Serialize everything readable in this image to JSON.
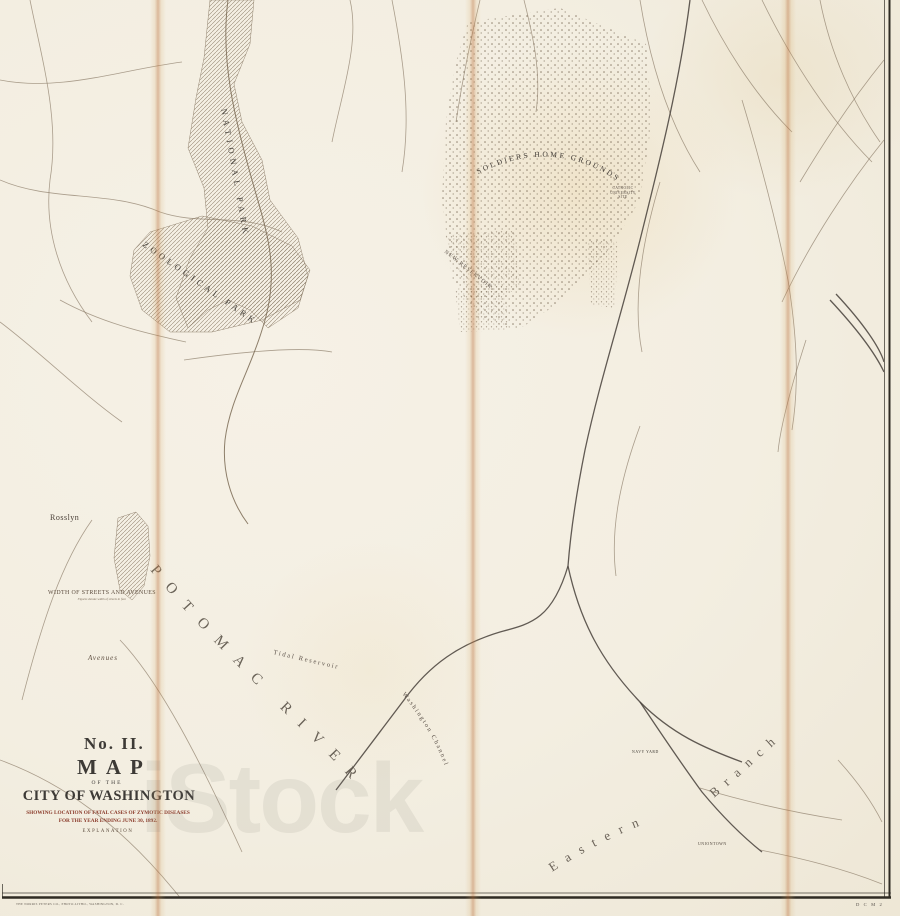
{
  "map": {
    "title_block": {
      "number": "No. II.",
      "map_word": "MAP",
      "of_the": "OF THE",
      "city": "CITY OF WASHINGTON",
      "subtitle1": "SHOWING LOCATION OF FATAL CASES OF ZYMOTIC DISEASES",
      "subtitle2": "FOR THE YEAR ENDING JUNE 30, 1892.",
      "explanation": "EXPLANATION",
      "legend": [
        {
          "label": "TYPHOID FEVER",
          "color": "#1f1f1f"
        },
        {
          "label": "MALARIAL FEVER",
          "color": "#24406e"
        },
        {
          "label": "SCARLET FEVER",
          "color": "#c8352b"
        },
        {
          "label": "DIPHTHERIA",
          "color": "#8d2d22"
        },
        {
          "label": "DIARRHŒAL DISEASES",
          "color": "#d1574a"
        }
      ]
    },
    "labels": {
      "rosslyn": "Rosslyn",
      "national_park": "NATIONAL PARK",
      "zoological_park": "ZOOLOGICAL PARK",
      "soldiers_home": "SOLDIERS HOME GROUNDS",
      "catholic_univ": "CATHOLIC UNIVERSITY SITE",
      "new_reservoir": "NEW RESERVOIR",
      "tidal_reservoir": "Tidal Reservoir",
      "washington_channel": "Washington Channel",
      "potomac_river": "POTOMAC RIVER",
      "eastern": "Eastern",
      "branch": "Branch",
      "navy_yard": "NAVY YARD",
      "uniontown": "UNIONTOWN"
    },
    "streets_block": {
      "heading": "WIDTH OF STREETS AND AVENUES",
      "sections": [
        {
          "name": "North",
          "rows": [
            "B.82 C.80 D.85 E.90 F.95 G.90 H.90 I.80 K.95 L.90 M.90",
            "N.90 O.90 P.98 Q.84 R.90 S.90 T.85 U.90 V.80 W.90"
          ]
        },
        {
          "name": "South",
          "rows": [
            "B.82 C.80 D.85 E.84 F.90 G.96 H.80 I.84 K.90 L.84 M.90",
            "N.85 O.90 P.84 Q.90 R.80 S.84 T.90 U.84 V.80"
          ]
        },
        {
          "name": "East",
          "rows": [
            "1.80 2.85 3.90 4.85 5.80 6.90 7.95 8.85 9.90 10.80 11.85",
            "12.90 13.80 14.95 15.88 16.80 17.84 18.80 19.84 20.80"
          ]
        },
        {
          "name": "West",
          "rows": [
            "1.84 2.80 3.90 4.85 5.80 6.90 7.95 8.85 9.90 10.80 11.85 12.90",
            "13.80 14.95 15.88 16.80 17.84 18.80 19.84 20.80 21.84 22.80 23.80 24.85",
            "25.80 26.84 27.80 28.85 29.80 30.84 31.80 32.85 33.80 34.84 35.80 36.84"
          ]
        }
      ],
      "caption": "Figures denote width of streets in feet."
    },
    "avenues_table": {
      "heading": "Avenues",
      "left": [
        {
          "name": "Connecticut",
          "val": "130"
        },
        {
          "name": "Delaware",
          "val": "160"
        },
        {
          "name": "Florida",
          "val": "120"
        },
        {
          "name": "Georgia",
          "val": "120"
        },
        {
          "name": "Indiana",
          "val": "120"
        },
        {
          "name": "Kentucky",
          "val": "90"
        },
        {
          "name": "Louisiana",
          "val": "129"
        },
        {
          "name": "Maryland",
          "val": "160"
        },
        {
          "name": "Massachusetts",
          "val": "160"
        },
        {
          "name": "Missouri",
          "val": "100"
        },
        {
          "name": "New York East of 6th St.",
          "val": "160"
        },
        {
          "name": "New York West of 6th St.",
          "val": "130"
        }
      ],
      "right": [
        {
          "name": "New Jersey",
          "val": "160"
        },
        {
          "name": "North Carolina",
          "val": "160"
        },
        {
          "name": "New Hampshire",
          "val": "130"
        },
        {
          "name": "Ohio",
          "val": "102"
        },
        {
          "name": "Pennsylvania East of 6th St.",
          "val": "160"
        },
        {
          "name": "Pennsylvania West of 6th St.",
          "val": "130"
        },
        {
          "name": "Rhode Island",
          "val": "130"
        },
        {
          "name": "South Carolina",
          "val": "160"
        },
        {
          "name": "Tennessee",
          "val": "160"
        },
        {
          "name": "Vermont",
          "val": "130"
        },
        {
          "name": "Virginia East of Canal",
          "val": "160"
        },
        {
          "name": "Virginia West of Canal",
          "val": "85"
        }
      ]
    },
    "case_markers": {
      "palette": {
        "typhoid": "#1f1f1f",
        "malarial": "#24406e",
        "scarlet": "#c8352b",
        "diphtheria": "#8d2d22",
        "diarrhoeal": "#d1574a"
      },
      "regions": [
        {
          "seed": 11,
          "x": 196,
          "y": 430,
          "w": 350,
          "h": 150,
          "counts": {
            "diarrhoeal": 30,
            "scarlet": 16,
            "diphtheria": 12,
            "malarial": 26,
            "typhoid": 11
          }
        },
        {
          "seed": 22,
          "x": 300,
          "y": 300,
          "w": 320,
          "h": 100,
          "counts": {
            "diarrhoeal": 14,
            "scarlet": 8,
            "diphtheria": 6,
            "malarial": 10,
            "typhoid": 5
          }
        },
        {
          "seed": 33,
          "x": 566,
          "y": 400,
          "w": 190,
          "h": 180,
          "counts": {
            "diarrhoeal": 18,
            "scarlet": 9,
            "diphtheria": 7,
            "malarial": 16,
            "typhoid": 7
          }
        },
        {
          "seed": 44,
          "x": 762,
          "y": 440,
          "w": 100,
          "h": 140,
          "counts": {
            "diarrhoeal": 6,
            "scarlet": 3,
            "diphtheria": 2,
            "malarial": 6,
            "typhoid": 2
          }
        },
        {
          "seed": 55,
          "x": 470,
          "y": 600,
          "w": 280,
          "h": 180,
          "counts": {
            "diarrhoeal": 24,
            "scarlet": 11,
            "diphtheria": 9,
            "malarial": 17,
            "typhoid": 9
          }
        },
        {
          "seed": 66,
          "x": 376,
          "y": 610,
          "w": 85,
          "h": 160,
          "counts": {
            "diarrhoeal": 9,
            "scarlet": 5,
            "diphtheria": 3,
            "malarial": 6,
            "typhoid": 3
          }
        },
        {
          "seed": 77,
          "x": 146,
          "y": 400,
          "w": 84,
          "h": 80,
          "counts": {
            "diarrhoeal": 6,
            "scarlet": 4,
            "diphtheria": 2,
            "malarial": 4,
            "typhoid": 2
          }
        },
        {
          "seed": 88,
          "x": 310,
          "y": 195,
          "w": 110,
          "h": 95,
          "counts": {
            "diarrhoeal": 3,
            "scarlet": 2,
            "diphtheria": 1,
            "malarial": 2,
            "typhoid": 1
          }
        },
        {
          "seed": 99,
          "x": 620,
          "y": 235,
          "w": 80,
          "h": 68,
          "counts": {
            "diarrhoeal": 3,
            "scarlet": 2,
            "diphtheria": 1,
            "malarial": 3,
            "typhoid": 1
          }
        },
        {
          "seed": 110,
          "x": 700,
          "y": 833,
          "w": 115,
          "h": 52,
          "counts": {
            "diarrhoeal": 6,
            "scarlet": 5,
            "diphtheria": 1,
            "malarial": 1,
            "typhoid": 0
          }
        },
        {
          "seed": 121,
          "x": 752,
          "y": 600,
          "w": 105,
          "h": 85,
          "counts": {
            "diarrhoeal": 3,
            "scarlet": 2,
            "diphtheria": 1,
            "malarial": 2,
            "typhoid": 1
          }
        }
      ],
      "outliers": [
        {
          "x": 680,
          "y": 143,
          "kind": "scarlet"
        },
        {
          "x": 838,
          "y": 36,
          "kind": "scarlet"
        },
        {
          "x": 347,
          "y": 128,
          "kind": "diarrhoeal"
        },
        {
          "x": 520,
          "y": 10,
          "kind": "scarlet"
        },
        {
          "x": 861,
          "y": 111,
          "kind": "malarial"
        },
        {
          "x": 866,
          "y": 118,
          "kind": "typhoid"
        },
        {
          "x": 300,
          "y": 95,
          "kind": "scarlet"
        },
        {
          "x": 420,
          "y": 62,
          "kind": "diarrhoeal"
        },
        {
          "x": 635,
          "y": 55,
          "kind": "scarlet"
        },
        {
          "x": 790,
          "y": 300,
          "kind": "malarial"
        },
        {
          "x": 212,
          "y": 332,
          "kind": "scarlet"
        },
        {
          "x": 132,
          "y": 446,
          "kind": "malarial"
        },
        {
          "x": 62,
          "y": 430,
          "kind": "typhoid"
        }
      ]
    },
    "imprint": "THE NORRIS PETERS CO., PHOTO-LITHO., WASHINGTON, D. C.",
    "plate_code": "D C M 2",
    "watermark": "iStock"
  }
}
